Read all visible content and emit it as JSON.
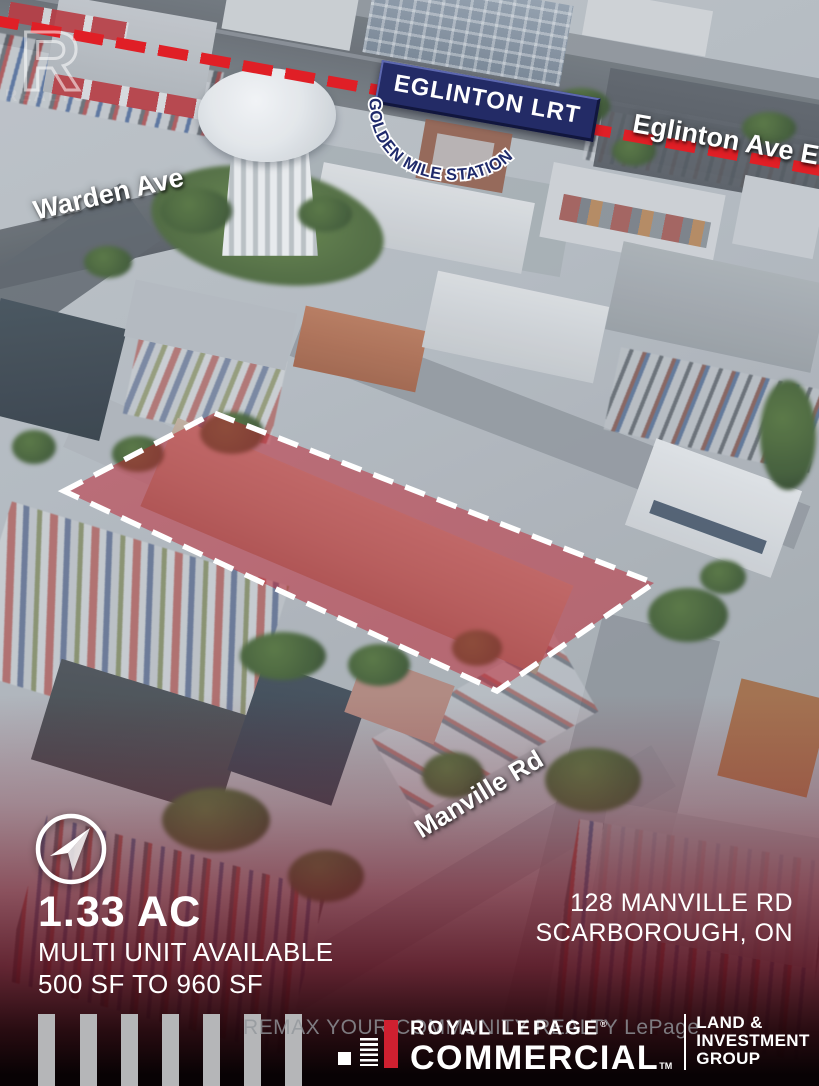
{
  "branding": {
    "realtor_monogram": "R",
    "realtor_label": "REALTOR",
    "realtor_reg": "®"
  },
  "map": {
    "lrt_badge": "EGLINTON LRT",
    "station_name": "GOLDEN MILE STATION",
    "street_eglinton": "Eglinton Ave E",
    "street_warden": "Warden Ave",
    "street_manville": "Manville Rd"
  },
  "listing": {
    "lot_size": "1.33 AC",
    "availability": "MULTI UNIT AVAILABLE",
    "unit_range": "500 SF TO 960 SF",
    "address_line1": "128 MANVILLE RD",
    "address_line2": "SCARBOROUGH, ON"
  },
  "footer": {
    "watermark": "REMAX YOUR COMMUNITY REALTY LePage",
    "brand_name": "ROYAL LEPAGE",
    "brand_reg": "®",
    "brand_division": "COMMERCIAL",
    "brand_tm": "TM",
    "group": [
      "LAND &",
      "INVESTMENT",
      "GROUP"
    ]
  },
  "icons": {
    "compass": "navigation-arrow-icon",
    "realtor": "realtor-r-monogram-icon",
    "lepage_mark": "royal-lepage-bar-mark-icon"
  },
  "colors": {
    "lrt_dash_red": "#e01f26",
    "lrt_badge_navy": "#232b66",
    "property_highlight_red": "#c01f2e",
    "property_outline": "#ffffff",
    "bottom_overlay_burgundy": "#701222",
    "footer_red_bar": "#cf2030",
    "footer_bar_gray": "#b5b6b8",
    "watermark_gray": "#93979c",
    "label_white": "#ffffff"
  }
}
